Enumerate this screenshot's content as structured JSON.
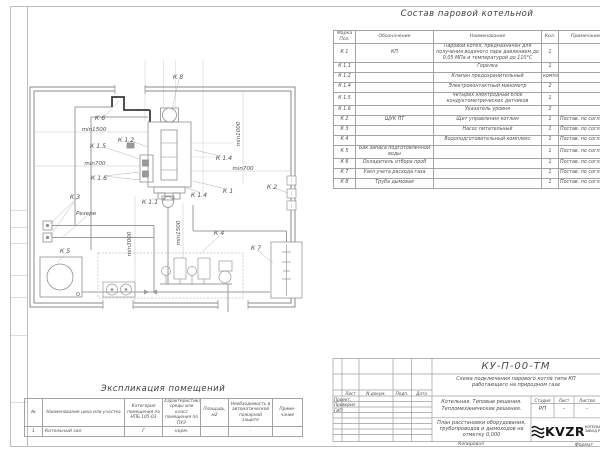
{
  "composition_table": {
    "title": "Состав паровой котельной",
    "headers": [
      "Марка Поз.",
      "Обозначение",
      "Наименование",
      "Кол.",
      "Примечание"
    ],
    "rows": [
      [
        "К 1",
        "КП",
        "Паровой котел, предназначен для получения водяного пара давлением до 0,05 МПа и температурой до 110°С",
        "1",
        ""
      ],
      [
        "К 1.1",
        "",
        "Горелка",
        "1",
        ""
      ],
      [
        "К 1.2",
        "",
        "Клапан предохранительный",
        "компл.",
        ""
      ],
      [
        "К 1.4",
        "",
        "Электроконтактный манометр",
        "2",
        ""
      ],
      [
        "К 1.5",
        "",
        "Четырех электродный блок кондуктометрических датчиков",
        "1",
        ""
      ],
      [
        "К 1.6",
        "",
        "Указатель уровня",
        "2",
        ""
      ],
      [
        "К 2",
        "ЩУК ПТ",
        "Щит управления котлом",
        "1",
        "Постав. по соглас."
      ],
      [
        "К 3",
        "",
        "Насос питательный",
        "1",
        "Постав. по соглас."
      ],
      [
        "К 4",
        "",
        "Водоподготовительный комплекс",
        "1",
        "Постав. по соглас."
      ],
      [
        "К 5",
        "Бак запаса подготовленной воды",
        "",
        "1",
        "Постав. по соглас."
      ],
      [
        "К 6",
        "Охладитель отбора проб",
        "",
        "1",
        "Постав. по соглас."
      ],
      [
        "К 7",
        "Узел учета расхода газа",
        "",
        "1",
        "Постав. по соглас."
      ],
      [
        "К 8",
        "Труба дымовая",
        "",
        "1",
        "Постав. по соглас."
      ]
    ]
  },
  "explication_table": {
    "title": "Экспликация помещений",
    "headers": [
      "№",
      "Наименование цеха или участка",
      "Категория помещения по НПБ 105-03",
      "Характеристика среды или класс помещения по ПУЭ",
      "Площадь, м2",
      "Необходимость в автоматической пожарной защите",
      "Приме- чание"
    ],
    "rows": [
      [
        "1",
        "Котельный зал",
        "Г",
        "норм.",
        "",
        "-",
        ""
      ]
    ]
  },
  "plan": {
    "labels": [
      "К 8",
      "К 6",
      "min1500",
      "К 1.2",
      "К 1.5",
      "min700",
      "К 1.6",
      "min1000",
      "К 1.4",
      "min700",
      "К 2",
      "К 1",
      "К 1.4",
      "К 1.1",
      "К 3",
      "Резерв",
      "К 5",
      "min3000",
      "min1500",
      "К 4",
      "К 7"
    ]
  },
  "title_block": {
    "doc_number": "КУ-П-00-ТМ",
    "doc_title": "Схема подключения парового котла типа КП работающего на природном газе",
    "sign_headers": [
      "Лист",
      "N докум.",
      "Подп.",
      "Дата"
    ],
    "sign_rows": [
      "Проект.",
      "Проверил",
      "ГИП"
    ],
    "project_line1": "Котельная. Типовые решения.",
    "project_line2": "Тепломеханические решения.",
    "sheet_caption": "План расстановки оборудования, трубопроводов и дымоходов на отметку 0,000",
    "stage_header": "Стадия",
    "sheet_header": "Лист",
    "sheets_header": "Листов",
    "stage": "РП",
    "sheet": "-",
    "sheets": "-",
    "logo": "KVZR",
    "company_line1": "КОТЕЛЬН",
    "company_line2": "ЗАВОД Р",
    "copied": "Копировал",
    "format": "Формат"
  }
}
